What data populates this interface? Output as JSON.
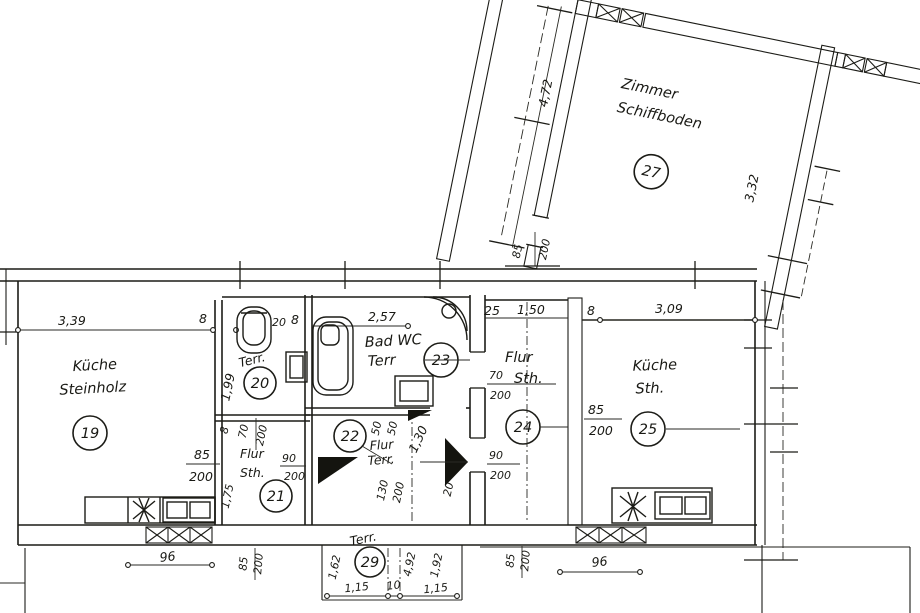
{
  "drawing_title": "Grundriss (floor plan)",
  "colors": {
    "ink": "#1c1c17",
    "paper": "#ffffff"
  },
  "icons": {
    "toilet": "toilet-icon",
    "bathtub": "bathtub-icon",
    "corner_shower": "corner-shower-icon",
    "washbasin": "washbasin-icon",
    "kitchen_sink": "kitchen-sink-icon",
    "stove": "stove-icon",
    "window": "window-icon",
    "door_swing": "door-swing-icon"
  },
  "rooms": {
    "r19": {
      "number": "19",
      "line1": "Küche",
      "line2": "Steinholz"
    },
    "r20": {
      "number": "20",
      "label": "Terr."
    },
    "r21": {
      "number": "21",
      "line1": "Flur",
      "line2": "Sth."
    },
    "r22": {
      "number": "22",
      "line1": "Flur",
      "line2": "Terr."
    },
    "r23": {
      "number": "23",
      "line1": "Bad WC",
      "line2": "Terr"
    },
    "r24": {
      "number": "24",
      "line1": "Flur",
      "line2": "Sth."
    },
    "r25": {
      "number": "25",
      "line1": "Küche",
      "line2": "Sth."
    },
    "r27": {
      "number": "27",
      "line1": "Zimmer",
      "line2": "Schiffboden"
    },
    "r29": {
      "number": "29",
      "label": "Terr."
    }
  },
  "dims": {
    "top": [
      "3,39",
      "8",
      "20",
      "8",
      "2,57",
      "25",
      "1,50",
      "8",
      "3,09"
    ],
    "r27_left": "4,72",
    "r27_right": "3,32",
    "junction_door": [
      "85",
      "200"
    ],
    "r19_door": [
      "85",
      "200"
    ],
    "r20_left": "1,99",
    "r20_door": [
      "8",
      "70",
      "200"
    ],
    "r21_door": [
      "90",
      "200"
    ],
    "r21_left": "1,75",
    "r22_top": [
      "50",
      "50",
      "1,30"
    ],
    "r22_bottom": [
      "130",
      "200",
      "20"
    ],
    "r24_door_top": [
      "70",
      "200"
    ],
    "r24_door_bottom": [
      "90",
      "200"
    ],
    "r25_left": [
      "85",
      "200"
    ],
    "bottom_left_width": "96",
    "bottom_left_door": [
      "85",
      "200"
    ],
    "bottom_right_width": "96",
    "bottom_right_door": [
      "85",
      "200"
    ],
    "r29_cols": [
      "1,62",
      "4,92",
      "1,92"
    ],
    "r29_bottom": [
      "1,15",
      "10",
      "1,15"
    ]
  }
}
